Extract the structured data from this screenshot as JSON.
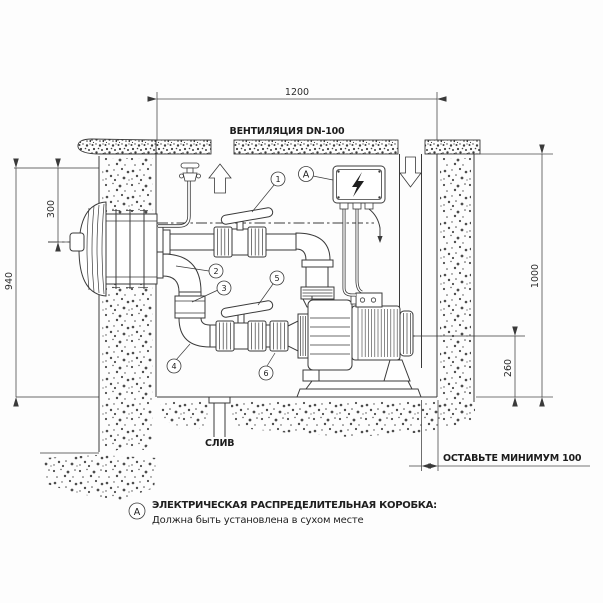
{
  "diagram": {
    "background": "#fdfdfd",
    "line_color": "#3a3a3a",
    "dimension_color": "#4a4a4a",
    "text_color": "#1f1f1f"
  },
  "labels": {
    "ventilation": "ВЕНТИЛЯЦИЯ DN-100",
    "drain": "СЛИВ",
    "min_clearance": "ОСТАВЬТЕ МИНИМУМ 100"
  },
  "dimensions": {
    "chamber_width": "1200",
    "nozzle_depth": "300",
    "pool_depth": "940",
    "chamber_height": "1000",
    "pump_axis_height": "260"
  },
  "callouts": {
    "c1": "1",
    "c2": "2",
    "c3": "3",
    "c4": "4",
    "c5": "5",
    "c6": "6",
    "electric_box": "A"
  },
  "legend": {
    "marker": "A",
    "title": "ЭЛЕКТРИЧЕСКАЯ РАСПРЕДЕЛИТЕЛЬНАЯ КОРОБКА:",
    "subtitle": "Должна быть установлена в сухом месте"
  },
  "icons": {
    "electric_hazard": "lightning-bolt",
    "vent_exhaust": "arrow-up",
    "vent_supply": "arrow-down"
  }
}
